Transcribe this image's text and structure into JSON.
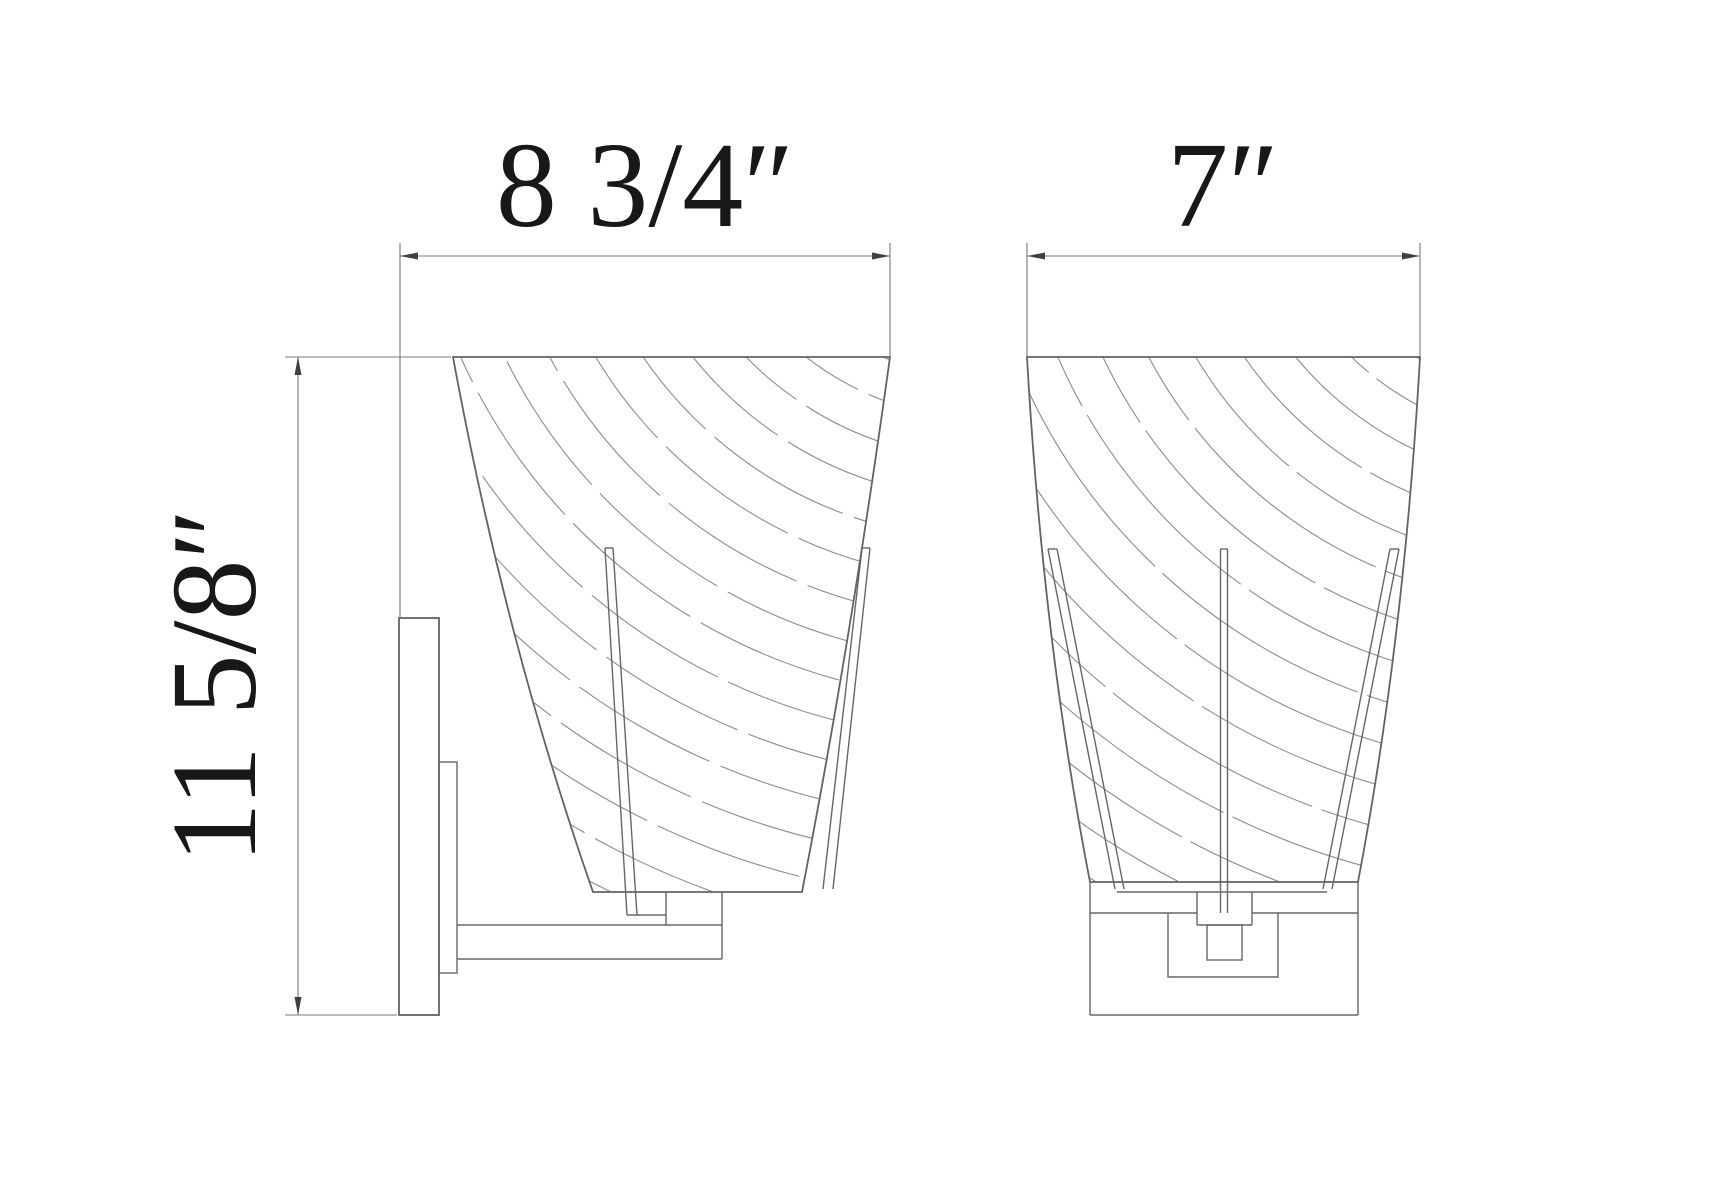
{
  "drawing": {
    "type": "technical dimension drawing",
    "subject": "wall sconce light fixture, two orthographic views",
    "colors": {
      "background": "#ffffff",
      "outline": "#636363",
      "swirl_texture": "#8c8c8c",
      "dimension_lines": "#787878",
      "dimension_text": "#181818"
    }
  },
  "dimensions": {
    "side_view_width": "8 3/4″",
    "front_view_width": "7″",
    "overall_height": "11 5/8″"
  }
}
